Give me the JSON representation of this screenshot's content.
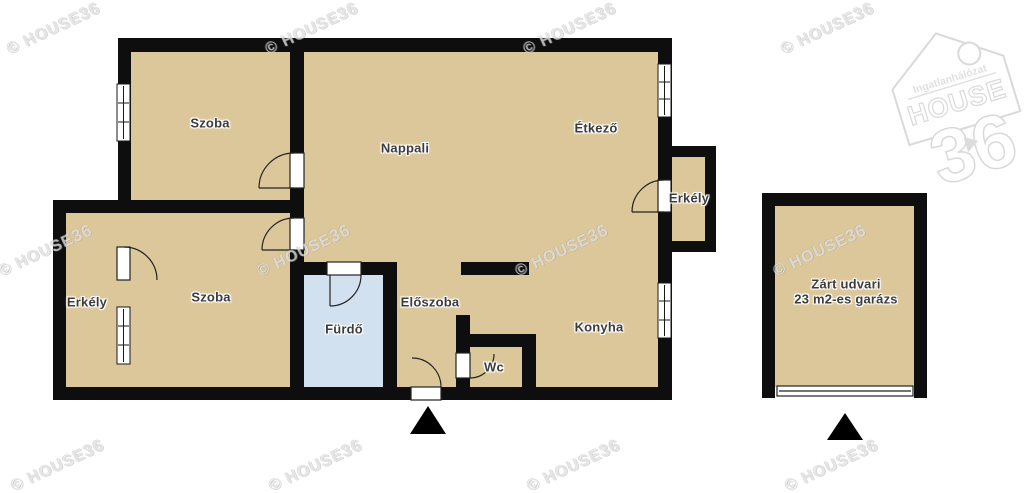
{
  "rooms": {
    "szoba_top": "Szoba",
    "nappali": "Nappali",
    "etkezo": "Étkező",
    "erkely_right": "Erkély",
    "erkely_left": "Erkély",
    "szoba_bottom": "Szoba",
    "furdo": "Fürdő",
    "eloszoba": "Előszoba",
    "konyha": "Konyha",
    "wc": "Wc",
    "garage_line1": "Zárt udvari",
    "garage_line2": "23 m2-es garázs"
  },
  "watermark": {
    "part1": "© HOUSE",
    "part2": "36"
  },
  "logo": {
    "top": "Ingatlanhálózat",
    "middle": "HOUSE",
    "number": "36"
  },
  "colors": {
    "floor": "#dcc79a",
    "bathroom_floor": "#d2e1f0",
    "wall": "#0e0e0e",
    "background": "#ffffff",
    "entrance_marker": "#000000"
  }
}
